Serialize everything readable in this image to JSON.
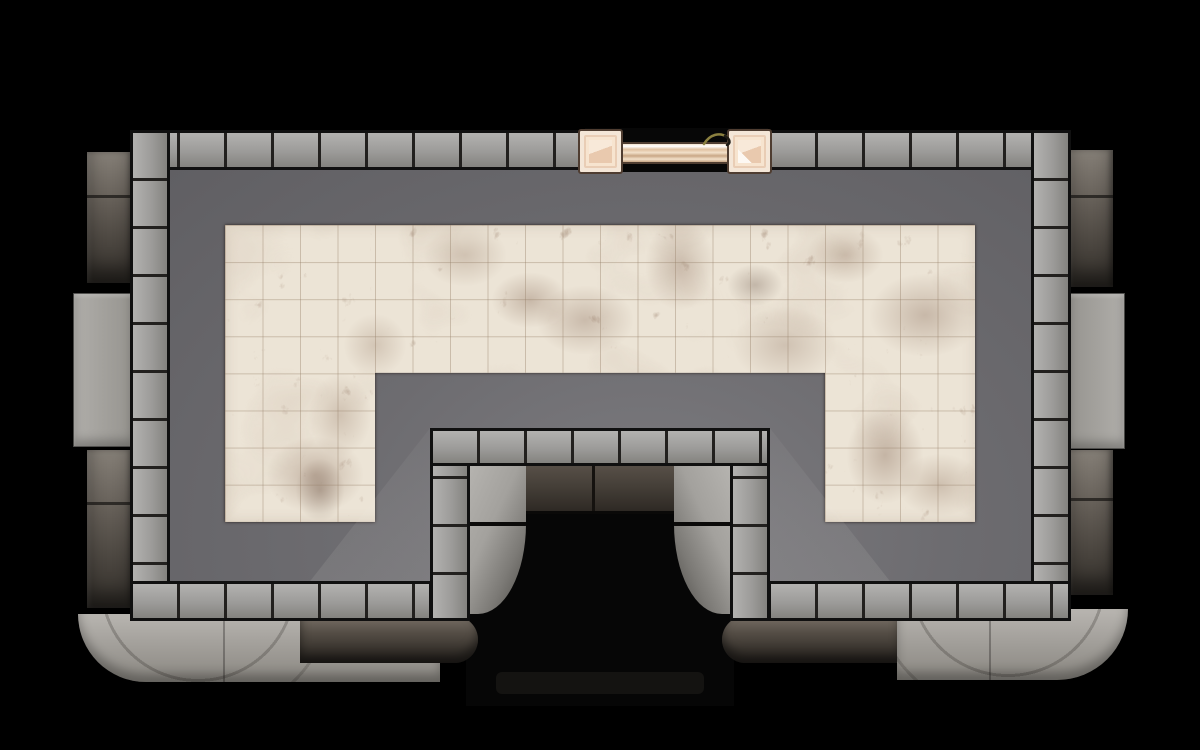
{
  "scene": {
    "title": "Stone Hall Battlemap",
    "view": "top-down",
    "visible_text": "none"
  },
  "palette": {
    "background": "#000000",
    "outline": "#101010",
    "stone_light": "#b3b2b0",
    "stone_mid": "#9c9b99",
    "stone_dark": "#84837f",
    "stone_seam": "#22201e",
    "floor_base": "#6d6c70",
    "floor_light": "#7d7c80",
    "floor_dark": "#605f63",
    "marble_base": "#ece4d6",
    "marble_vein": "#6b4a38",
    "marble_grid": "rgba(150,128,105,0.40)",
    "door_outline": "#4f3d31",
    "door_frame_fill": "#f4e6d7",
    "door_ring": "#e9cdb5",
    "door_panel": "#f7e4cf",
    "door_panel_shade": "#e9c9ae",
    "door_bar_light": "#f2e0c9",
    "door_bar_mid": "#dfc0a0",
    "door_bar_dark": "#c9a786",
    "door_accent": "#8b8040",
    "buttress_dark_top": "#857f77",
    "buttress_dark_bottom": "#322e29",
    "buttress_light_a": "#b0aeaa",
    "buttress_light_b": "#96948f",
    "ledge_light_a": "#b8b5b0",
    "ledge_light_b": "#8a8781",
    "ledge_dark_a": "#776f66",
    "ledge_dark_b": "#2b2723",
    "passage_lintel_a": "#574f47",
    "passage_lintel_b": "#2e2924",
    "passage_face_a": "#b6b4b0",
    "passage_face_b": "#4a4844",
    "passage_black": "#060606"
  },
  "grid": {
    "tile_px": 37.5,
    "marble_cols": 20,
    "marble_band_rows": 4,
    "marble_column_rows": 4
  },
  "features": {
    "room": {
      "label": "Main hall with marble tile floor"
    },
    "door": {
      "label": "Double door in top wall",
      "posts": 2
    },
    "passage": {
      "label": "Bottom alcove passage"
    },
    "buttresses": {
      "label": "Exterior wall buttresses",
      "left": 3,
      "right": 3
    },
    "ledges": {
      "label": "Exterior rounded roof ledges"
    }
  }
}
